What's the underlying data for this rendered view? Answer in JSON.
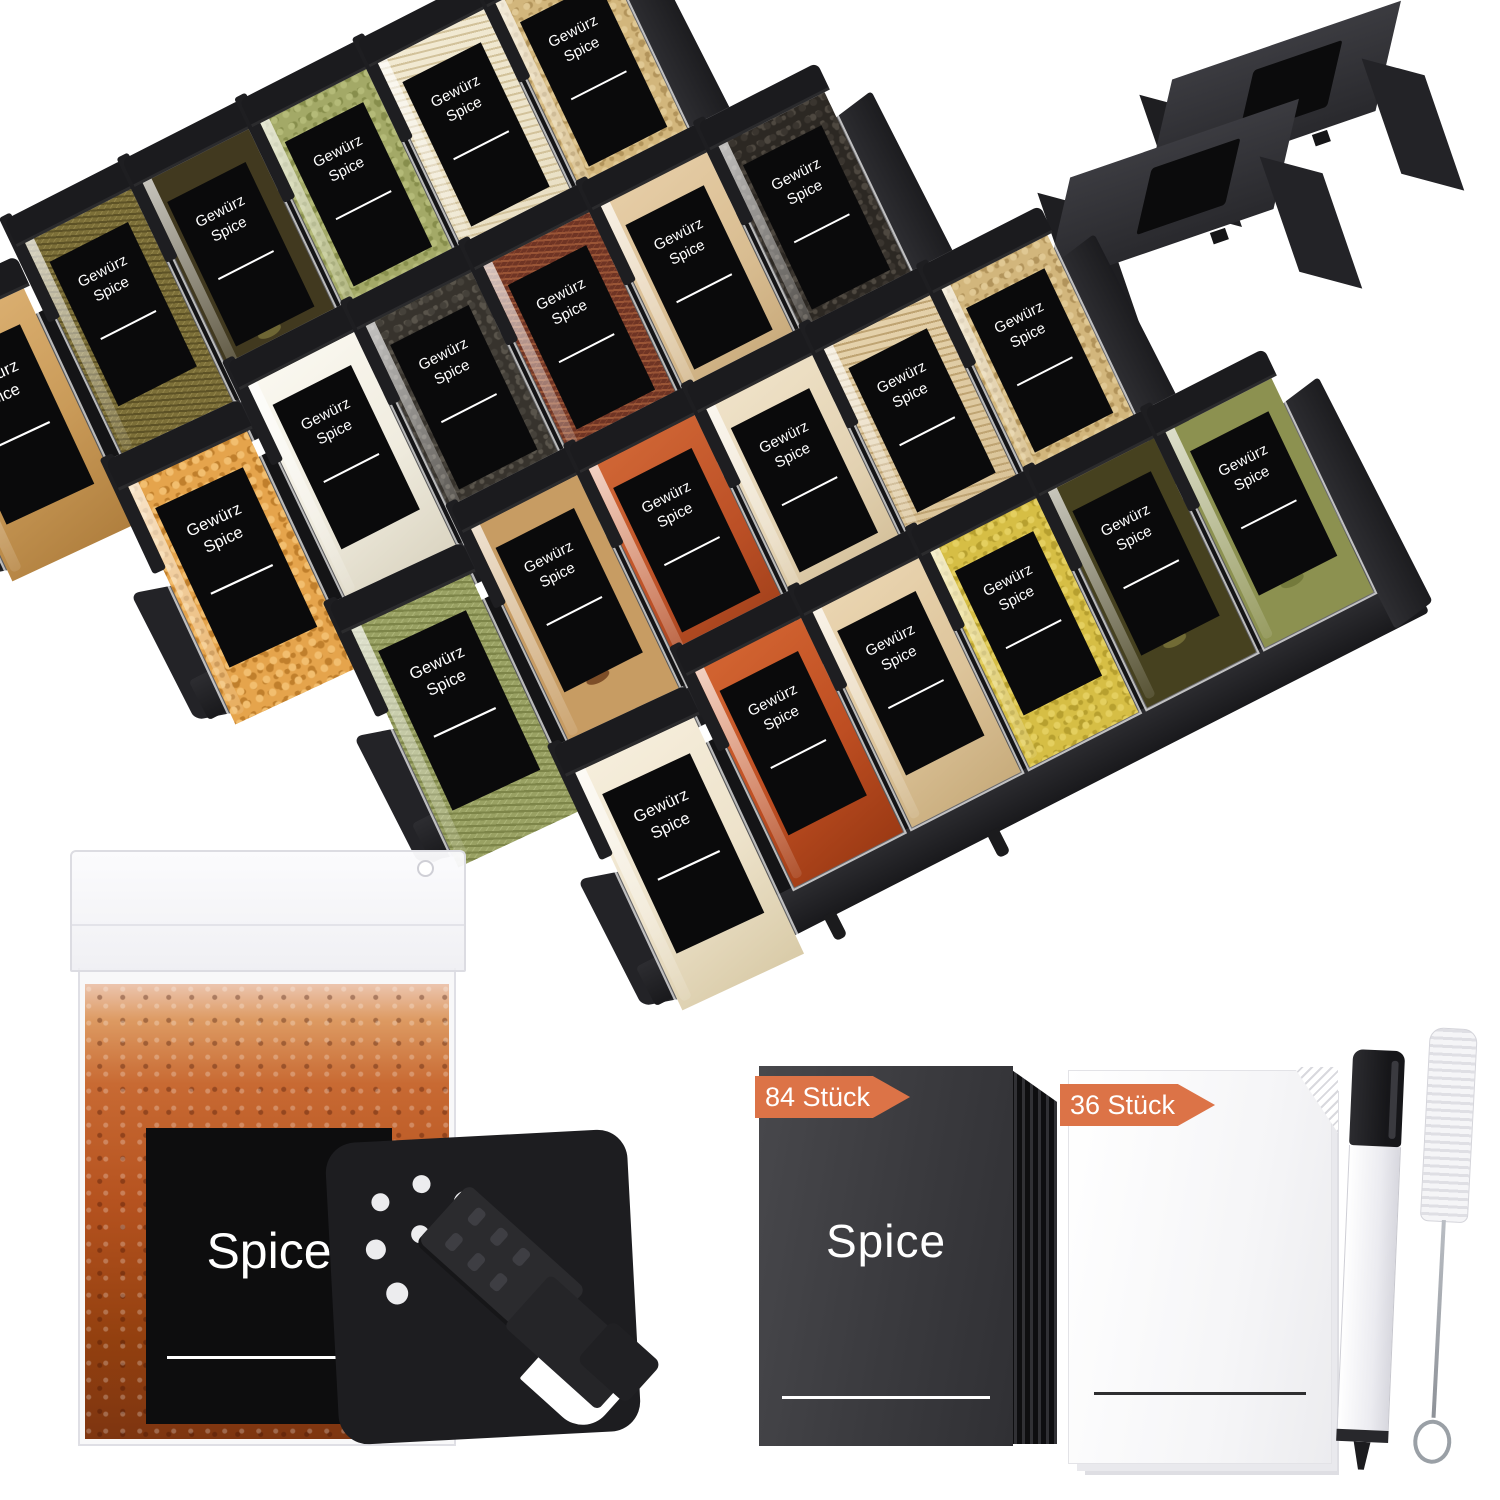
{
  "scene": {
    "background": "#ffffff"
  },
  "badge_color": "#DC7347",
  "rack": {
    "jar_label": {
      "line1": "Gewürz",
      "line2": "Spice"
    },
    "tray_color": "#202023",
    "cap_color": "#1b1b1e",
    "rows": [
      {
        "jars": [
          {
            "name": "golden-powder",
            "base": "#C99A58",
            "light": "#DDB274",
            "speck": "#B07F3E",
            "pattern": "powder"
          },
          {
            "name": "olive-herbs",
            "base": "#7C6F38",
            "light": "#92844A",
            "speck": "#5D5226",
            "pattern": "herbs"
          },
          {
            "name": "dark-bay-leaves",
            "base": "#41391F",
            "light": "#55502B",
            "speck": "#6E6634",
            "pattern": "leaves"
          },
          {
            "name": "green-split-peas",
            "base": "#A3A967",
            "light": "#B4BA78",
            "speck": "#878E4C",
            "pattern": "seeds"
          },
          {
            "name": "cream-rice",
            "base": "#E8DEC2",
            "light": "#F2EAD3",
            "speck": "#D2C29B",
            "pattern": "grain"
          },
          {
            "name": "tan-ring-seeds",
            "base": "#D2B67C",
            "light": "#E0C893",
            "speck": "#B2945B",
            "pattern": "seeds"
          }
        ]
      },
      {
        "jars": [
          {
            "name": "popcorn-kernels",
            "base": "#E5A44C",
            "light": "#F2BE6F",
            "speck": "#C07F2C",
            "pattern": "seeds"
          },
          {
            "name": "white-salt",
            "base": "#F0ECDF",
            "light": "#FAF8F0",
            "speck": "#DBD5C2",
            "pattern": "powder"
          },
          {
            "name": "black-chia-seeds",
            "base": "#37332D",
            "light": "#45413A",
            "speck": "#59544B",
            "pattern": "seeds"
          },
          {
            "name": "chili-shreds",
            "base": "#6F3424",
            "light": "#84432D",
            "speck": "#9A5536",
            "pattern": "herbs"
          },
          {
            "name": "beige-powder",
            "base": "#D8BC90",
            "light": "#E6CDA6",
            "speck": "#C3A474",
            "pattern": "powder"
          },
          {
            "name": "black-peppercorns",
            "base": "#2C2823",
            "light": "#3A352F",
            "speck": "#4E4840",
            "pattern": "seeds"
          }
        ]
      },
      {
        "jars": [
          {
            "name": "green-dried-herbs",
            "base": "#99A163",
            "light": "#AAB276",
            "speck": "#7D8549",
            "pattern": "herbs"
          },
          {
            "name": "star-anise",
            "base": "#C79C63",
            "light": "#D8B07B",
            "speck": "#7D4E28",
            "pattern": "leaves"
          },
          {
            "name": "paprika-powder",
            "base": "#BC5026",
            "light": "#D06635",
            "speck": "#9C3D18",
            "pattern": "powder"
          },
          {
            "name": "cream-powder",
            "base": "#E3D2B2",
            "light": "#EFE2C8",
            "speck": "#CFBA92",
            "pattern": "powder"
          },
          {
            "name": "tan-rice-grains",
            "base": "#D8C195",
            "light": "#E5D2AC",
            "speck": "#BFA473",
            "pattern": "grain"
          },
          {
            "name": "tan-ring-seeds",
            "base": "#D2B67C",
            "light": "#E0C893",
            "speck": "#B2945B",
            "pattern": "seeds"
          }
        ]
      },
      {
        "jars": [
          {
            "name": "cream-white-powder",
            "base": "#EDE2CA",
            "light": "#F6EEDC",
            "speck": "#D9CBA8",
            "pattern": "powder"
          },
          {
            "name": "red-paprika",
            "base": "#BE4E22",
            "light": "#D26431",
            "speck": "#9C3A14",
            "pattern": "powder"
          },
          {
            "name": "light-beige-powder",
            "base": "#DDC49A",
            "light": "#EAD5B1",
            "speck": "#C8AC7C",
            "pattern": "powder"
          },
          {
            "name": "yellow-mustard-seeds",
            "base": "#D6BE45",
            "light": "#E4CF5F",
            "speck": "#B7A02F",
            "pattern": "seeds"
          },
          {
            "name": "dark-bay-leaves",
            "base": "#46411F",
            "light": "#5A552C",
            "speck": "#716B35",
            "pattern": "leaves"
          },
          {
            "name": "olive-leaves",
            "base": "#8C9150",
            "light": "#9CA160",
            "speck": "#747A3C",
            "pattern": "leaves"
          }
        ]
      }
    ]
  },
  "brackets": {
    "count": 2,
    "deck_color": "#323236",
    "velcro_color": "#0B0B0C"
  },
  "big_jar": {
    "label": "Spice",
    "fill_main": "#B5521F"
  },
  "shaker_lid": {
    "color": "#1D1D20",
    "hole_color": "#ECECEE",
    "hole_count": 7
  },
  "label_packs": [
    {
      "badge": "84 Stück",
      "label": "Spice",
      "card_color": "#3A3A3E",
      "underline_color": "#FFFFFF"
    },
    {
      "badge": "36 Stück",
      "label": "",
      "card_color": "#F5F5F7",
      "underline_color": "#2E2E30"
    }
  ],
  "pen": {
    "cap_color": "#1E1E21",
    "body_color": "#F5F5F7"
  },
  "brush": {
    "bristle_color": "#EEEEF0",
    "wire_color": "#9AA0A6"
  }
}
